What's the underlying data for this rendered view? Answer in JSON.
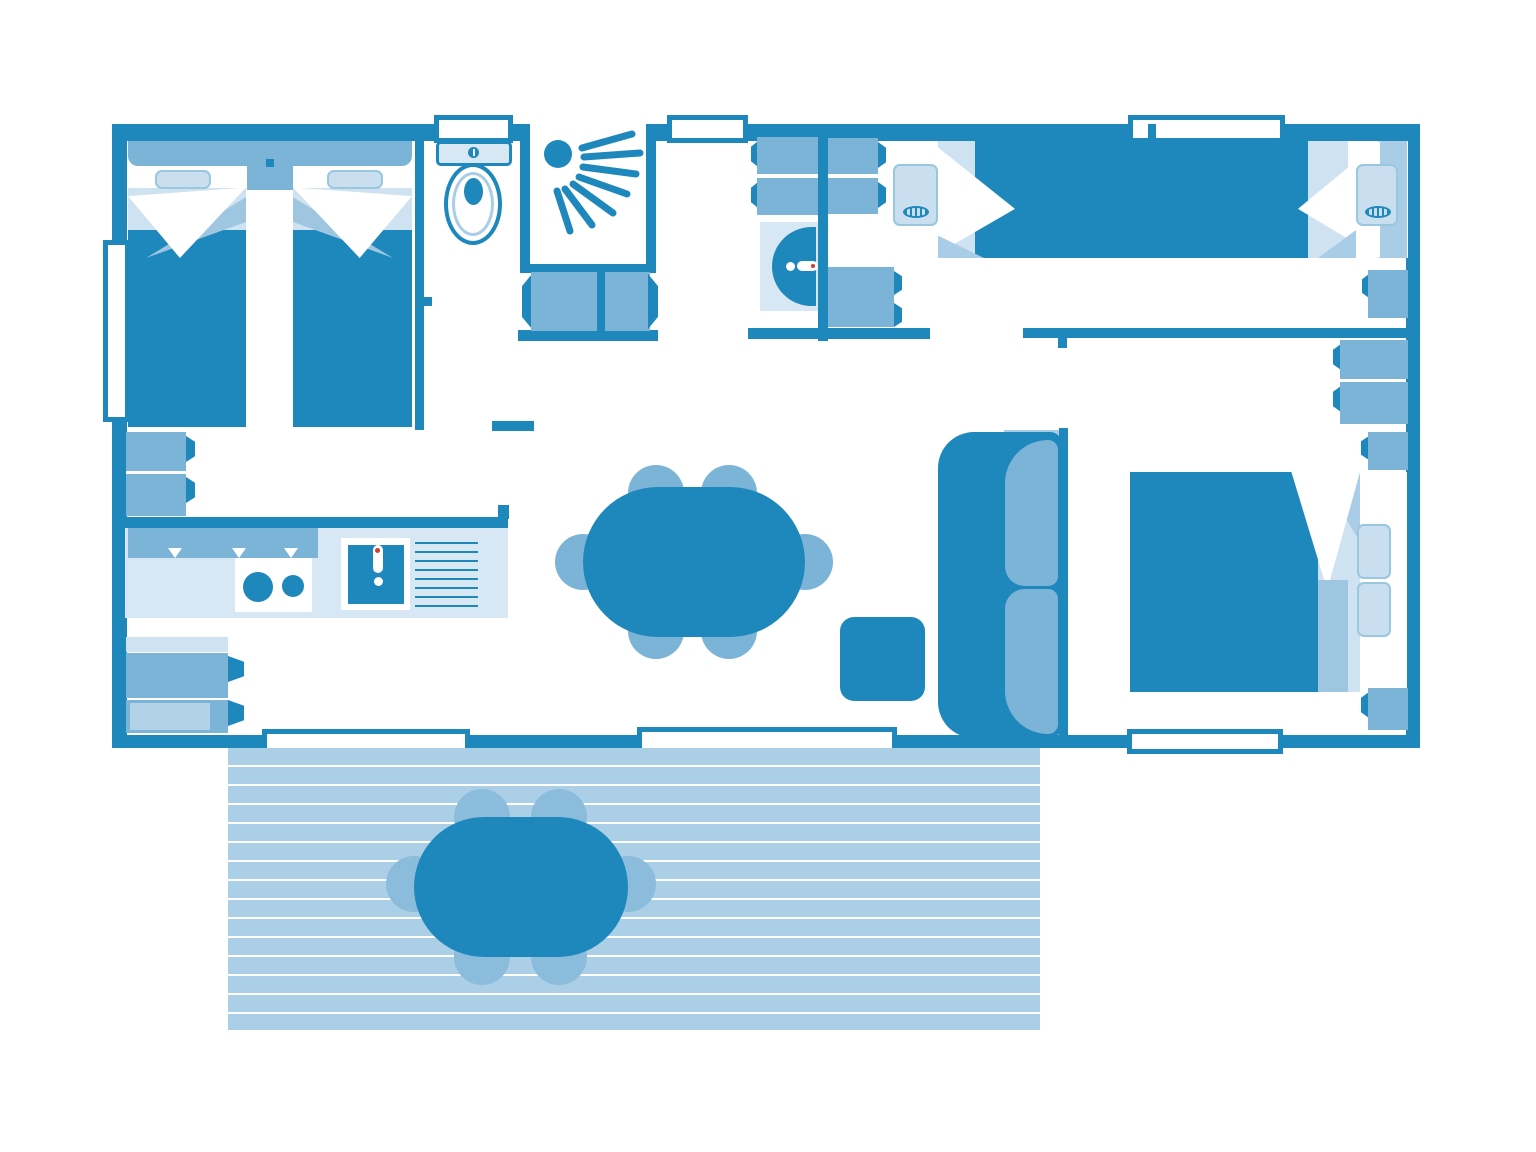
{
  "document": {
    "kind": "floor-plan",
    "text_visible": false
  },
  "colors": {
    "primary": "#1e87bc",
    "medium": "#7cb4d8",
    "mediumLight": "#8cbcdb",
    "shadow": "#9fc6e1",
    "lite": "#a9cde6",
    "pale": "#d7e7f4",
    "pale2": "#cfe2f1",
    "deck": "#abcfe7",
    "white": "#ffffff",
    "accentRed": "#d33b2f"
  },
  "labels": {
    "plan": "Mobile home floor plan with terrace",
    "twin_bedroom": "Bedroom with two single beds",
    "bed_single": "Single bed",
    "nightstand": "Nightstand",
    "wardrobe": "Wardrobe",
    "toilet": "Toilet (WC)",
    "shower": "Shower",
    "washbasin": "Washbasin",
    "double_bedroom": "Master bedroom",
    "double_bed": "Double bed",
    "sofa": "Sofa",
    "coffee_table": "Coffee table",
    "dining_table": "Dining table with six chairs",
    "chair": "Chair",
    "kitchen": "Kitchen worktop",
    "stove": "Hob with two burners",
    "sink": "Kitchen sink",
    "drainer": "Draining board",
    "fridge": "Kitchen unit",
    "terrace": "Covered terrace deck",
    "terrace_table": "Outdoor table with six chairs",
    "window": "Window",
    "bay_door": "Sliding bay door",
    "door_swing": "Door swing",
    "wall": "Wall",
    "pillow": "Pillow"
  },
  "inventory": {
    "bedrooms": 3,
    "single_beds": 4,
    "double_beds": 1,
    "dining_chairs": 6,
    "terrace_chairs": 6,
    "windows": 6,
    "doors": 1
  }
}
